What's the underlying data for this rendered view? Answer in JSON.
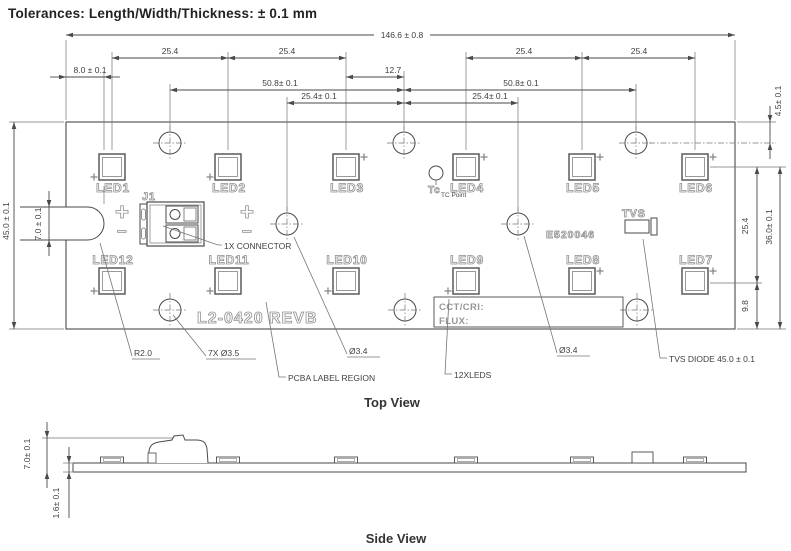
{
  "title": "Tolerances: Length/Width/Thickness: ± 0.1 mm",
  "view_labels": {
    "top": {
      "text": "Top View",
      "x": 392,
      "y": 407
    },
    "side": {
      "text": "Side View",
      "x": 396,
      "y": 543
    }
  },
  "colors": {
    "line": "#4a4a4a",
    "thin": "#757575",
    "silk": "#8f8f8f",
    "dim_text": "#3f3f3f"
  },
  "board": {
    "x": 66,
    "y": 122,
    "w": 669,
    "h": 207,
    "slot": {
      "y1": 207,
      "y2": 240,
      "x_open": 20,
      "x_cap": 87.5,
      "r": 16.5
    },
    "part_number": {
      "text": "L2-0420 REVB",
      "x": 197,
      "y": 323,
      "size": 16
    },
    "cert_number": {
      "text": "E520046",
      "x": 546,
      "y": 238,
      "size": 10.5
    },
    "label_box": {
      "x": 434,
      "y": 297,
      "w": 189,
      "h": 30,
      "line1": {
        "text": "CCT/CRI:",
        "x": 439,
        "y": 310
      },
      "line2": {
        "text": "FLUX:",
        "x": 439,
        "y": 324
      }
    }
  },
  "leds": {
    "size": 26,
    "inset": 3.5,
    "top_row_y": 154,
    "bottom_row_y": 268,
    "items": [
      {
        "name": "LED1",
        "cx": 112,
        "row": "top",
        "plus": "bl"
      },
      {
        "name": "LED2",
        "cx": 228,
        "row": "top",
        "plus": "bl"
      },
      {
        "name": "LED3",
        "cx": 346,
        "row": "top",
        "plus": "tr"
      },
      {
        "name": "LED4",
        "cx": 466,
        "row": "top",
        "plus": "tr"
      },
      {
        "name": "LED5",
        "cx": 582,
        "row": "top",
        "plus": "tr"
      },
      {
        "name": "LED6",
        "cx": 695,
        "row": "top",
        "plus": "tr"
      },
      {
        "name": "LED12",
        "cx": 112,
        "row": "bottom",
        "plus": "bl"
      },
      {
        "name": "LED11",
        "cx": 228,
        "row": "bottom",
        "plus": "bl"
      },
      {
        "name": "LED10",
        "cx": 346,
        "row": "bottom",
        "plus": "bl"
      },
      {
        "name": "LED9",
        "cx": 466,
        "row": "bottom",
        "plus": "bl"
      },
      {
        "name": "LED8",
        "cx": 582,
        "row": "bottom",
        "plus": "tr"
      },
      {
        "name": "LED7",
        "cx": 695,
        "row": "bottom",
        "plus": "tr"
      }
    ]
  },
  "hole_r": 11,
  "holes": [
    {
      "x": 170,
      "y": 143
    },
    {
      "x": 404,
      "y": 143
    },
    {
      "x": 636,
      "y": 143
    },
    {
      "x": 287,
      "y": 224
    },
    {
      "x": 518,
      "y": 224
    },
    {
      "x": 170,
      "y": 310
    },
    {
      "x": 405,
      "y": 310
    },
    {
      "x": 637,
      "y": 310
    }
  ],
  "connector": {
    "ref": {
      "text": "J1",
      "x": 142,
      "y": 200,
      "size": 11
    },
    "plus1": {
      "text": "+",
      "x": 115,
      "y": 220
    },
    "minus1": {
      "text": "−",
      "x": 117,
      "y": 237
    },
    "plus2": {
      "text": "+",
      "x": 240,
      "y": 220
    },
    "minus2": {
      "text": "−",
      "x": 242,
      "y": 237
    }
  },
  "tvs": {
    "label": {
      "text": "TVS",
      "x": 622,
      "y": 217,
      "size": 11
    },
    "body": {
      "x": 625,
      "y": 220,
      "w": 24,
      "h": 13
    },
    "cap": {
      "x": 651,
      "y": 218,
      "w": 6,
      "h": 17
    }
  },
  "tc_point": {
    "circle": {
      "x": 436,
      "y": 173,
      "r": 7
    },
    "label": {
      "text": "Tc",
      "x": 428,
      "y": 193,
      "size": 10
    },
    "sublabel": {
      "text": "TC Point",
      "x": 441,
      "y": 197
    }
  },
  "dimensions": [
    {
      "text": "146.6 ± 0.8",
      "dir": "h",
      "y": 35,
      "x1": 66,
      "x2": 735,
      "tx": 402,
      "ty": 38,
      "gap": [
        374,
        430
      ]
    },
    {
      "text": "25.4",
      "dir": "h",
      "y": 58,
      "x1": 112,
      "x2": 228,
      "tx": 170,
      "ty": 54
    },
    {
      "text": "25.4",
      "dir": "h",
      "y": 58,
      "x1": 228,
      "x2": 346,
      "tx": 287,
      "ty": 54
    },
    {
      "text": "25.4",
      "dir": "h",
      "y": 58,
      "x1": 466,
      "x2": 582,
      "tx": 524,
      "ty": 54
    },
    {
      "text": "25.4",
      "dir": "h",
      "y": 58,
      "x1": 582,
      "x2": 695,
      "tx": 639,
      "ty": 54
    },
    {
      "text": "8.0 ± 0.1",
      "dir": "h",
      "y": 77,
      "x1": 66,
      "x2": 104,
      "tx": 90,
      "ty": 73,
      "outside": true
    },
    {
      "text": "12.7",
      "dir": "h",
      "y": 77,
      "x1": 346,
      "x2": 404,
      "tx": 393,
      "ty": 73
    },
    {
      "text": "50.8± 0.1",
      "dir": "h",
      "y": 90,
      "x1": 170,
      "x2": 404,
      "tx": 280,
      "ty": 86
    },
    {
      "text": "50.8± 0.1",
      "dir": "h",
      "y": 90,
      "x1": 404,
      "x2": 636,
      "tx": 521,
      "ty": 86
    },
    {
      "text": "25.4± 0.1",
      "dir": "h",
      "y": 103,
      "x1": 287,
      "x2": 404,
      "tx": 319,
      "ty": 99
    },
    {
      "text": "25.4± 0.1",
      "dir": "h",
      "y": 103,
      "x1": 404,
      "x2": 518,
      "tx": 490,
      "ty": 99
    },
    {
      "text": "45.0 ± 0.1",
      "dir": "v",
      "x": 14,
      "y1": 122,
      "y2": 329,
      "tx": 9,
      "ty": 221
    },
    {
      "text": "7.0 ± 0.1",
      "dir": "v",
      "x": 49,
      "y1": 207,
      "y2": 240,
      "tx": 41,
      "ty": 224,
      "outside": true
    },
    {
      "text": "4.5± 0.1",
      "dir": "v",
      "x": 770,
      "y1": 122,
      "y2": 143,
      "tx": 781,
      "ty": 101,
      "outside": true
    },
    {
      "text": "25.4",
      "dir": "v",
      "x": 757,
      "y1": 167,
      "y2": 283,
      "tx": 748,
      "ty": 226
    },
    {
      "text": "36.0± 0.1",
      "dir": "v",
      "x": 780,
      "y1": 167,
      "y2": 329,
      "tx": 772,
      "ty": 227
    },
    {
      "text": "9.8",
      "dir": "v",
      "x": 757,
      "y1": 283,
      "y2": 329,
      "tx": 748,
      "ty": 306
    },
    {
      "text": "7.0± 0.1",
      "dir": "v",
      "x": 47,
      "y1": 438,
      "y2": 472,
      "tx": 30,
      "ty": 454,
      "outside": true
    },
    {
      "text": "1.6± 0.1",
      "dir": "v",
      "x": 69,
      "y1": 463,
      "y2": 472,
      "tx": 59,
      "ty": 503,
      "outside": true,
      "tail": 46
    }
  ],
  "ext_lines": [
    {
      "x1": 66,
      "y1": 40,
      "x2": 66,
      "y2": 120
    },
    {
      "x1": 735,
      "y1": 40,
      "x2": 735,
      "y2": 120
    },
    {
      "x1": 112,
      "y1": 52,
      "x2": 112,
      "y2": 150
    },
    {
      "x1": 228,
      "y1": 52,
      "x2": 228,
      "y2": 150
    },
    {
      "x1": 346,
      "y1": 52,
      "x2": 346,
      "y2": 150
    },
    {
      "x1": 466,
      "y1": 52,
      "x2": 466,
      "y2": 150
    },
    {
      "x1": 582,
      "y1": 52,
      "x2": 582,
      "y2": 150
    },
    {
      "x1": 695,
      "y1": 52,
      "x2": 695,
      "y2": 150
    },
    {
      "x1": 104,
      "y1": 71,
      "x2": 104,
      "y2": 150
    },
    {
      "x1": 104,
      "y1": 186,
      "x2": 104,
      "y2": 204
    },
    {
      "x1": 170,
      "y1": 84,
      "x2": 170,
      "y2": 130
    },
    {
      "x1": 404,
      "y1": 71,
      "x2": 404,
      "y2": 130
    },
    {
      "x1": 636,
      "y1": 84,
      "x2": 636,
      "y2": 130
    },
    {
      "x1": 287,
      "y1": 97,
      "x2": 287,
      "y2": 211
    },
    {
      "x1": 518,
      "y1": 97,
      "x2": 518,
      "y2": 211
    },
    {
      "x1": 9,
      "y1": 122,
      "x2": 64,
      "y2": 122
    },
    {
      "x1": 9,
      "y1": 329,
      "x2": 64,
      "y2": 329
    },
    {
      "x1": 737,
      "y1": 122,
      "x2": 776,
      "y2": 122
    },
    {
      "x1": 649,
      "y1": 143,
      "x2": 776,
      "y2": 143,
      "dash": true
    },
    {
      "x1": 710,
      "y1": 167,
      "x2": 786,
      "y2": 167
    },
    {
      "x1": 710,
      "y1": 283,
      "x2": 762,
      "y2": 283
    },
    {
      "x1": 737,
      "y1": 329,
      "x2": 786,
      "y2": 329
    },
    {
      "x1": 42,
      "y1": 438,
      "x2": 180,
      "y2": 438
    },
    {
      "x1": 63,
      "y1": 463,
      "x2": 72,
      "y2": 463
    },
    {
      "x1": 63,
      "y1": 472,
      "x2": 72,
      "y2": 472
    }
  ],
  "callouts": [
    {
      "text": "R2.0",
      "pts": [
        [
          100,
          243
        ],
        [
          132,
          356
        ]
      ],
      "ux1": 132,
      "ux2": 160,
      "uy": 359,
      "tx": 134,
      "ty": 356
    },
    {
      "text": "7X Ø3.5",
      "pts": [
        [
          173,
          315
        ],
        [
          206,
          356
        ]
      ],
      "ux1": 206,
      "ux2": 256,
      "uy": 359,
      "tx": 208,
      "ty": 356
    },
    {
      "text": "Ø3.4",
      "pts": [
        [
          294,
          237
        ],
        [
          347,
          354
        ]
      ],
      "ux1": 347,
      "ux2": 380,
      "uy": 357,
      "tx": 349,
      "ty": 354
    },
    {
      "text": "PCBA LABEL REGION",
      "pts": [
        [
          266,
          302
        ],
        [
          279,
          377
        ],
        [
          286,
          377
        ]
      ],
      "tx": 288,
      "ty": 381
    },
    {
      "text": "12XLEDS",
      "pts": [
        [
          449,
          299
        ],
        [
          445,
          374
        ],
        [
          452,
          374
        ]
      ],
      "tx": 454,
      "ty": 378
    },
    {
      "text": "Ø3.4",
      "pts": [
        [
          524,
          236
        ],
        [
          557,
          353
        ]
      ],
      "ux1": 557,
      "ux2": 590,
      "uy": 356,
      "tx": 559,
      "ty": 353
    },
    {
      "text": "TVS DIODE 45.0 ± 0.1",
      "pts": [
        [
          643,
          239
        ],
        [
          660,
          358
        ],
        [
          667,
          358
        ]
      ],
      "tx": 669,
      "ty": 362
    },
    {
      "text": "1X CONNECTOR",
      "pts": [
        [
          163,
          226
        ],
        [
          218,
          245
        ],
        [
          222,
          245
        ]
      ],
      "tx": 224,
      "ty": 249
    }
  ],
  "side_view": {
    "board": {
      "x": 73,
      "y": 463,
      "w": 673,
      "h": 9
    },
    "bump_xs": [
      112,
      228,
      346,
      466,
      582,
      695
    ],
    "bump": {
      "w": 23,
      "h": 6
    },
    "tvs_bump": {
      "x": 632,
      "y": 452,
      "w": 21,
      "h": 11
    }
  }
}
